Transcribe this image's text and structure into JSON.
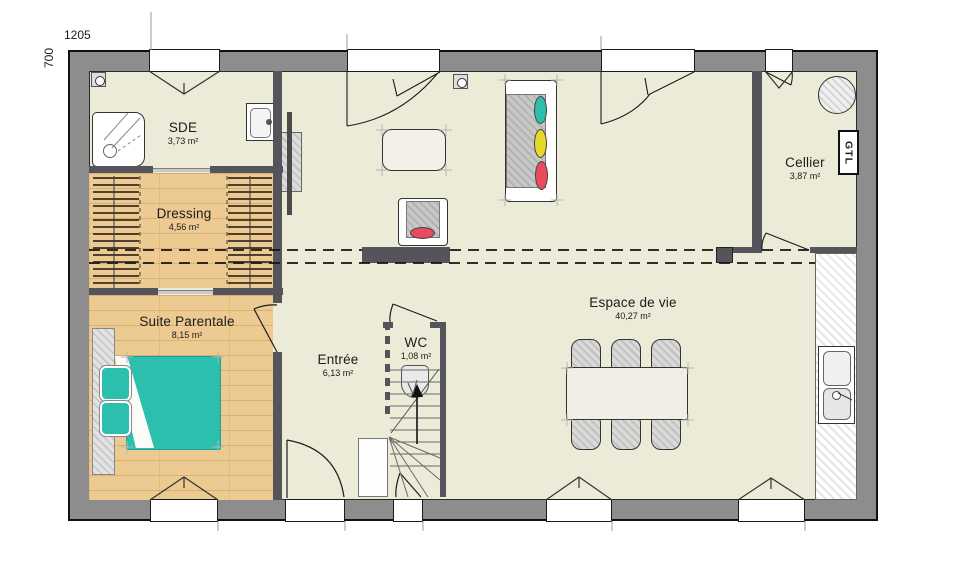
{
  "dimensions": {
    "width_label": "1205",
    "height_label": "700"
  },
  "rooms": {
    "sde": {
      "name": "SDE",
      "area": "3,73 m²"
    },
    "dressing": {
      "name": "Dressing",
      "area": "4,56 m²"
    },
    "suite": {
      "name": "Suite Parentale",
      "area": "8,15 m²"
    },
    "entree": {
      "name": "Entrée",
      "area": "6,13 m²"
    },
    "wc": {
      "name": "WC",
      "area": "1,08 m²"
    },
    "espace": {
      "name": "Espace de vie",
      "area": "40,27 m²"
    },
    "cellier": {
      "name": "Cellier",
      "area": "3,87 m²"
    }
  },
  "labels": {
    "gtl": "GTL"
  },
  "colors": {
    "exterior_wall": "#8d8d8d",
    "interior_wall": "#54545a",
    "floor": "#ecebd7",
    "wood_floor": "#ecca92",
    "accent_teal": "#2cbfae",
    "accent_yellow": "#e5d829",
    "accent_red": "#e84a5e"
  }
}
